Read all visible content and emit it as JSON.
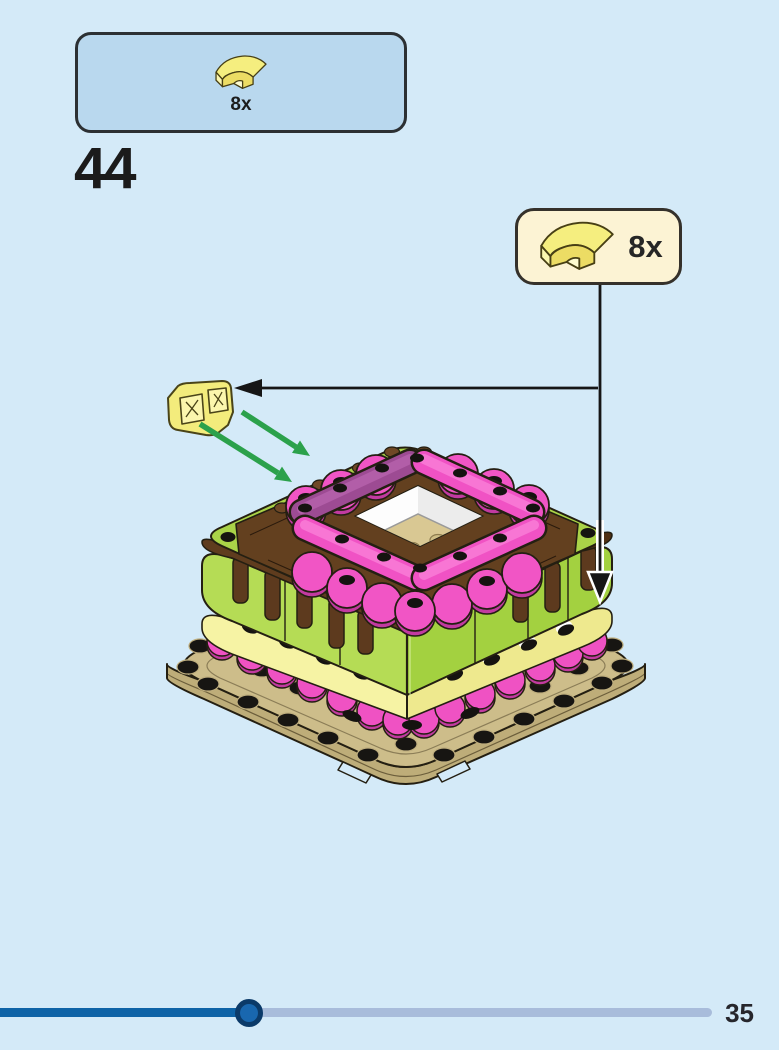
{
  "page": {
    "number": "35",
    "background_color": "#d4eaf8"
  },
  "step": {
    "number": "44"
  },
  "parts_panel": {
    "quantity": "8x",
    "piece": "curved-slope-1x2",
    "piece_color_name": "bright-light-yellow",
    "panel_color": "#b9d8ee"
  },
  "callout": {
    "quantity": "8x",
    "piece": "curved-slope-1x2",
    "piece_color_name": "bright-light-yellow",
    "panel_color": "#fcf3d4"
  },
  "figure": {
    "name": "heart-box-assembly-step-44",
    "model": "heart-shaped box on tan base plate",
    "colors": {
      "base_tan": "#cdbd8a",
      "base_tan_side": "#bead79",
      "wall_green": "#b5dc55",
      "wall_green_shade": "#a3d140",
      "band_yellow": "#f6f3a4",
      "scallop_pink": "#f155c5",
      "scallop_pink_shade": "#c23aa0",
      "bar_pink": "#f052c4",
      "bar_purple": "#9d4b93",
      "plate_brown": "#63401f",
      "interior_white": "#fdfdfd",
      "floor_tan": "#d9c893",
      "outline": "#241f12",
      "guide_arrow_green": "#2ba14b",
      "guide_arrow_black": "#161616"
    }
  },
  "progress": {
    "value_percent": 35,
    "fill_color": "#0e63a7",
    "track_color": "#a8bcdb",
    "thumb_color": "#1967af",
    "thumb_ring_color": "#0b3a69"
  }
}
